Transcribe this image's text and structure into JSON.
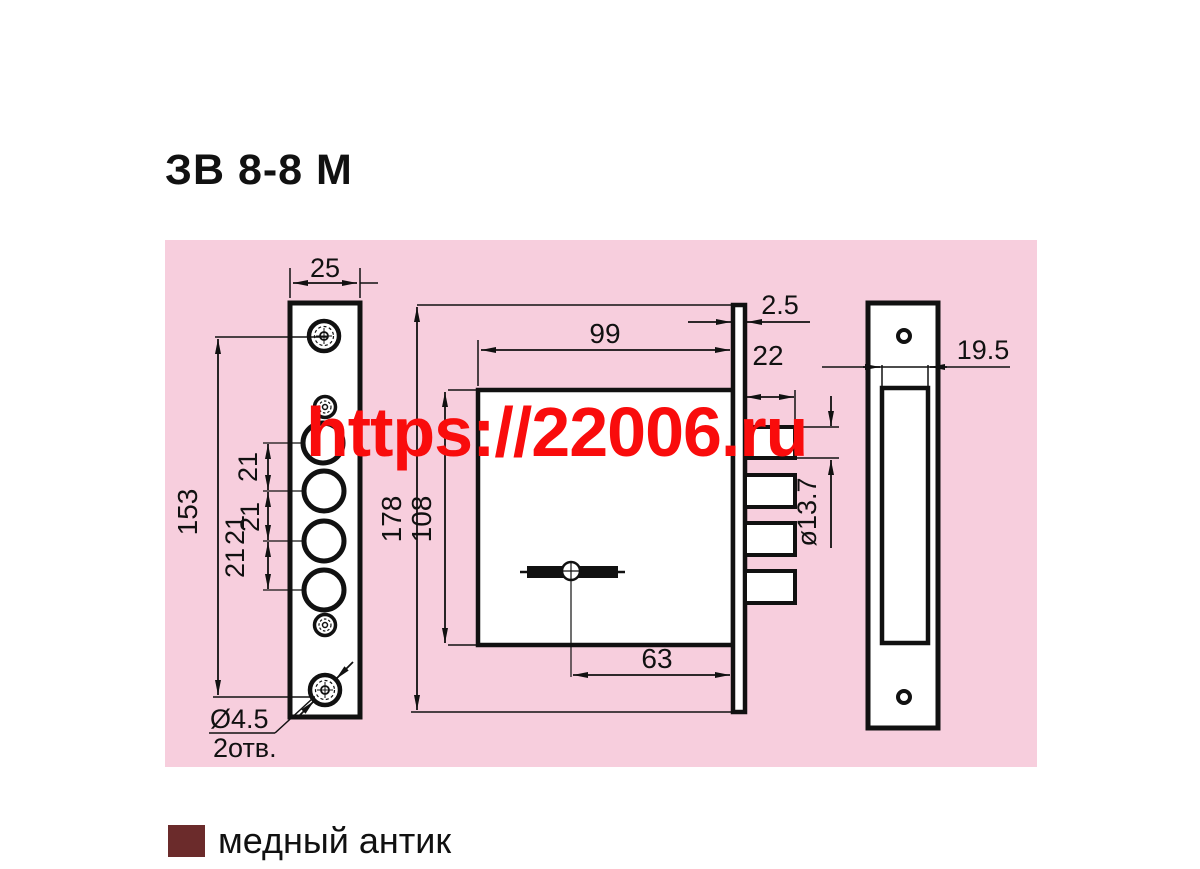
{
  "title": "ЗВ 8-8 М",
  "watermark": "https://22006.ru",
  "colors": {
    "panel_background": "#f7cedd",
    "watermark_red": "#f90c0c",
    "legend_swatch": "#6b2b2b",
    "line_color": "#111111"
  },
  "legend": {
    "label": "медный антик"
  },
  "drawing": {
    "faceplate_front": {
      "width": "25",
      "height": "153",
      "hole_spacing": [
        "21",
        "21",
        "21",
        "21"
      ],
      "screw_hole_dia": "Ø4.5",
      "screw_hole_count": "2отв."
    },
    "body_side": {
      "face_thickness": "2.5",
      "body_width": "99",
      "bolt_throw": "22",
      "bolt_dia": "ø13.7",
      "face_height": "178",
      "body_height": "108",
      "key_backset": "63"
    },
    "strike_plate": {
      "slot_width": "19.5"
    }
  }
}
